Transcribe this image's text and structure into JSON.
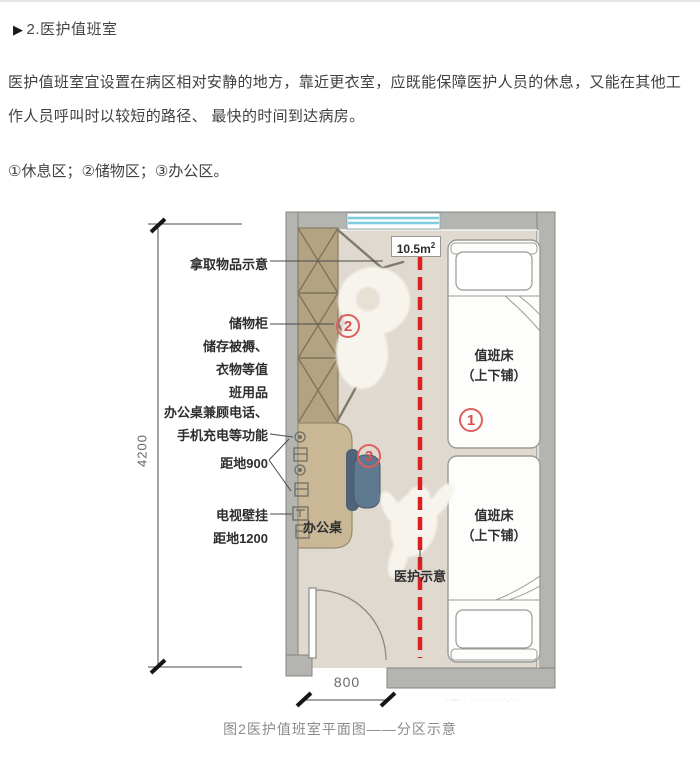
{
  "article": {
    "heading_arrow": "▶",
    "heading": "2.医护值班室",
    "paragraph": "医护值班室宜设置在病区相对安静的地方，靠近更衣室，应既能保障医护人员的休息，又能在其他工作人员呼叫时以较短的路径、 最快的时间到达病房。",
    "zones": "①休息区；②储物区；③办公区。",
    "caption": "图2医护值班室平面图——分区示意",
    "watermark": "·— · ·········.···"
  },
  "plan": {
    "area_value": "10.5m",
    "area_sup": "2",
    "labels": {
      "take_items": "拿取物品示意",
      "cabinet_1": "储物柜",
      "cabinet_2": "储存被褥、",
      "cabinet_3": "衣物等值",
      "cabinet_4": "班用品",
      "desk_fn_1": "办公桌兼顾电话、",
      "desk_fn_2": "手机充电等功能",
      "height_900": "距地900",
      "tv_1": "电视壁挂",
      "tv_2": "距地1200",
      "desk": "办公桌",
      "bed_line1": "值班床",
      "bed_line2": "（上下铺）",
      "staff": "医护示意"
    },
    "dims": {
      "door_width": "800",
      "room_depth": "4200"
    },
    "markers": {
      "m1": "1",
      "m2": "2",
      "m3": "3"
    },
    "colors": {
      "dashed_line": "#dc1f1f",
      "marker": "#dd5f5f",
      "wardrobe": "#b3a382",
      "desk": "#c9b795",
      "chair": "#5e7990",
      "floor": "#e0d9cf",
      "wall": "#b4b4b1",
      "window": "#7ecbdc"
    }
  }
}
